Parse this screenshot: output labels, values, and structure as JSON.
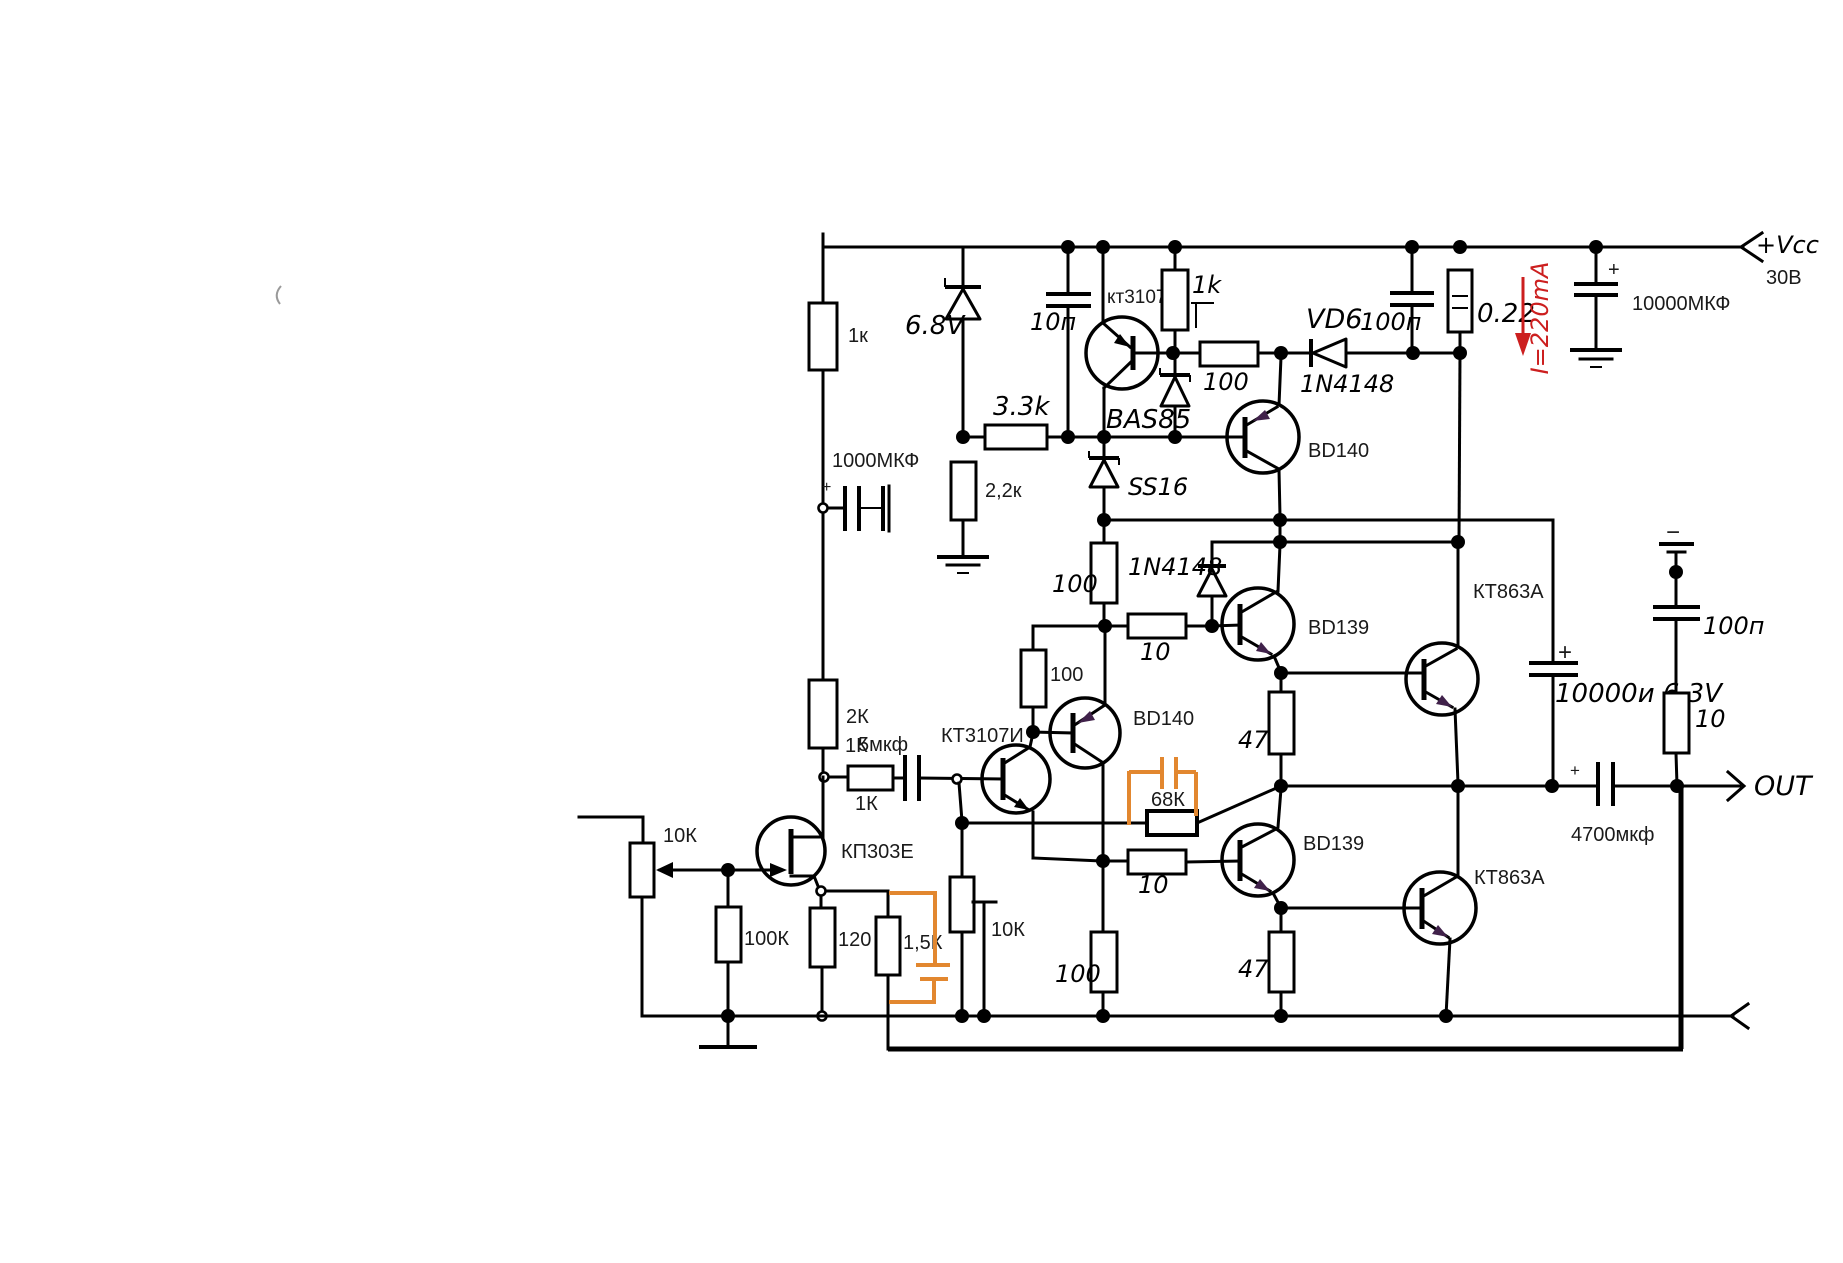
{
  "diagram": {
    "kind": "circuit-schematic",
    "subject": "transistor audio power amplifier output stage",
    "power_rail": "+Vcc",
    "rail_voltage": "30В",
    "output_terminal": "OUT",
    "annotation_current": "I=220mA"
  },
  "colors": {
    "wire": "#000000",
    "highlight_orange": "#e2872f",
    "annotation_red": "#cc1f1f",
    "background": "#ffffff",
    "emitter_arrow_purple": "#40214a"
  },
  "components": {
    "transistors": [
      "кт3107",
      "BD140",
      "BD140",
      "BD139",
      "BD139",
      "КТ863А",
      "КТ863А",
      "КТ3107И",
      "КП303Е"
    ],
    "diodes": [
      "6.8V zener",
      "BAS85",
      "SS16",
      "VD6 1N4148",
      "1N4148"
    ],
    "resistors": [
      "1к",
      "1k",
      "3.3k",
      "2,2к",
      "100",
      "0.22",
      "2К/1К",
      "1К",
      "100",
      "100",
      "10",
      "100",
      "68К",
      "10",
      "47",
      "47",
      "100",
      "10",
      "10К",
      "100К",
      "120",
      "1,5К",
      "10К"
    ],
    "capacitors": [
      "10п",
      "100п",
      "10000МКФ",
      "1000МКФ",
      "5мкф",
      "10000и 6.3V",
      "100п",
      "4700мкф",
      "orange cap across 68К",
      "orange cap across 1,5К"
    ]
  },
  "texts": {
    "vcc_label": "+Vcc",
    "vcc_voltage": "30В",
    "cap_10000mkf": "10000МКФ",
    "current_note": "I=220mA",
    "r_022": "0.22",
    "cap_100p_top": "100п",
    "vd6_ref": "VD6",
    "vd6_part": "1N4148",
    "r_100_top": "100",
    "r_1k_trim": "1k",
    "q_kt3107": "кт3107",
    "cap_10p": "10п",
    "zener_68v": "6.8V",
    "r_1k_left": "1к",
    "r_33k": "3.3k",
    "r_22k": "2,2к",
    "cap_1000mkf": "1000МКФ",
    "plus_1000": "+",
    "d_bas85": "BAS85",
    "d_ss16": "SS16",
    "r_100_mid": "100",
    "d_1n4148_mid": "1N4148",
    "r_10_mid": "10",
    "q_bd140_1": "BD140",
    "q_bd139_1": "BD139",
    "q_kt863a_1": "КТ863А",
    "cap_10000u": "10000и 6.3V",
    "plus_10000u": "+",
    "minus_mark": "−",
    "cap_100p_right": "100п",
    "r_10_right": "10",
    "out_label": "OUT",
    "cap_4700": "4700мкф",
    "plus_4700": "+",
    "r_100_vert2": "100",
    "q_bd140_2": "BD140",
    "q_kt3107i": "КТ3107И",
    "cap_5mkf": "5мкф",
    "r_2k": "2К",
    "r_1k_alt": "1К",
    "r_1k_series": "1К",
    "q_kp303e": "КП303Е",
    "r_10k_pot": "10К",
    "r_100k": "100К",
    "r_120": "120",
    "r_15k": "1,5К",
    "r_10k_2": "10К",
    "r_68k": "68К",
    "r_47_1": "47",
    "r_10_low": "10",
    "q_bd139_2": "BD139",
    "q_kt863a_2": "КТ863А",
    "r_47_2": "47",
    "r_100_low": "100"
  }
}
